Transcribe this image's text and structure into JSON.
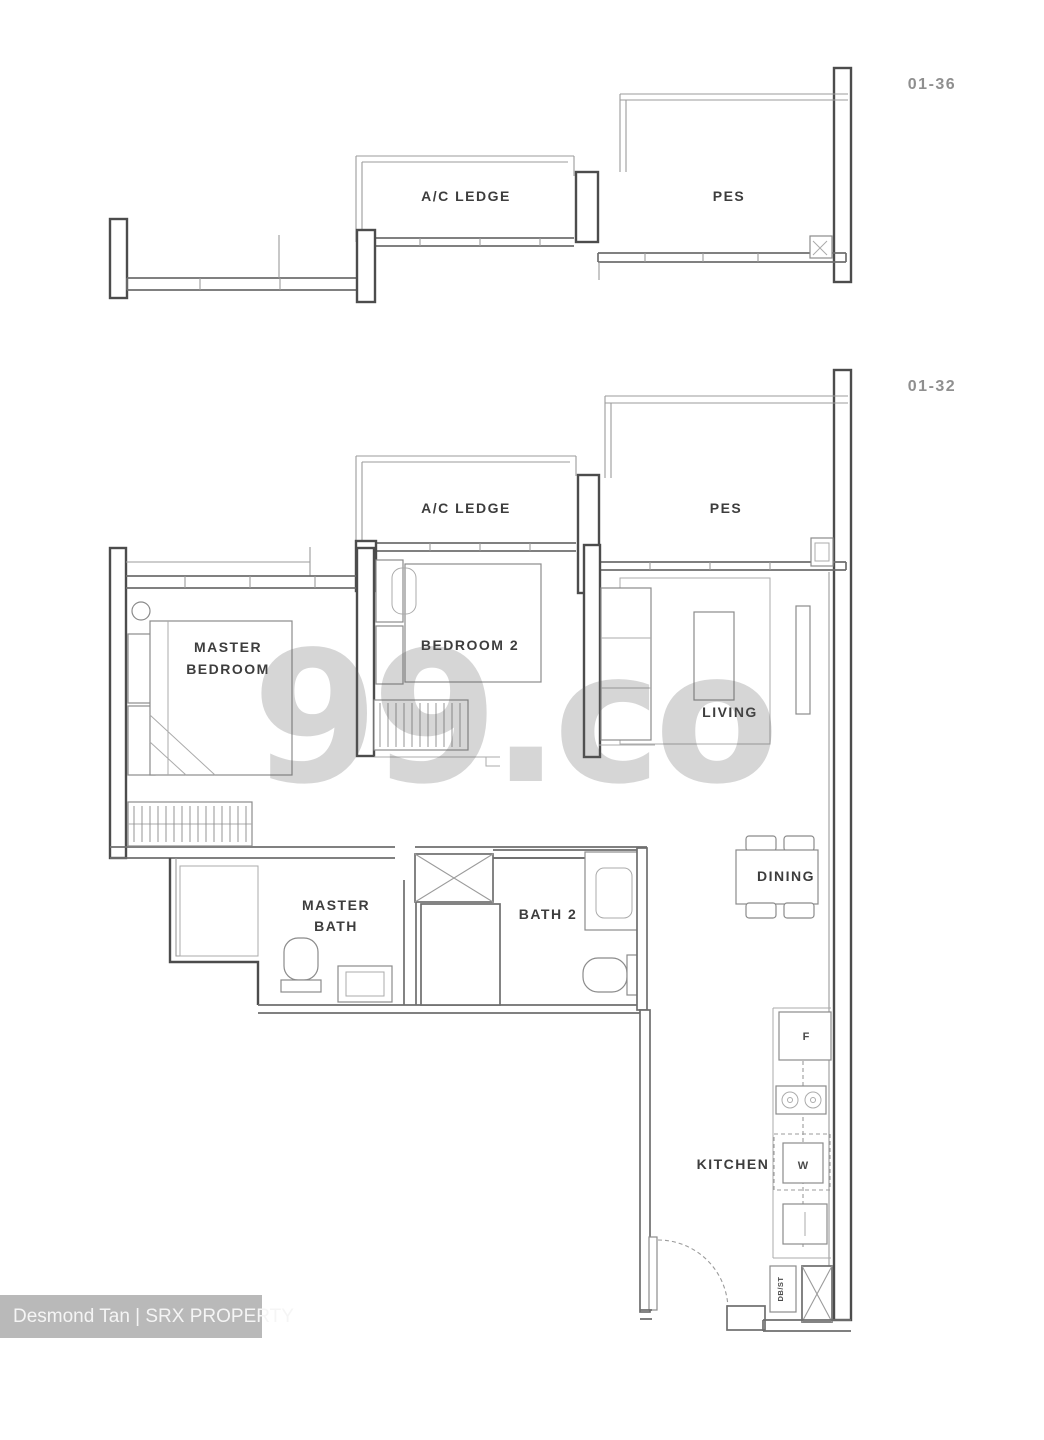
{
  "page": {
    "background": "#ffffff"
  },
  "watermark": {
    "text": "99.co",
    "color_hint": "#d2d2d2"
  },
  "credit_bar": {
    "text": "Desmond Tan | SRX PROPERTY",
    "background": "#b9b9b9",
    "text_color": "#f5f5f5"
  },
  "colors": {
    "wall_dark": "#4c4c4c",
    "wall_mid": "#6e6e6e",
    "line_light": "#9b9b9b",
    "room_label": "#3d3d3d",
    "unit_label": "#8f8f8f"
  },
  "top_plan": {
    "unit_id": "01-36",
    "ac_ledge_label": "A/C LEDGE",
    "pes_label": "PES"
  },
  "main_plan": {
    "unit_id": "01-32",
    "ac_ledge_label": "A/C LEDGE",
    "pes_label": "PES",
    "master_bedroom_label_line1": "MASTER",
    "master_bedroom_label_line2": "BEDROOM",
    "bedroom2_label": "BEDROOM 2",
    "living_label": "LIVING",
    "dining_label": "DINING",
    "master_bath_label_line1": "MASTER",
    "master_bath_label_line2": "BATH",
    "bath2_label": "BATH 2",
    "kitchen_label": "KITCHEN",
    "dbst_label": "DB/ST",
    "fridge_label": "F",
    "washer_label": "W"
  }
}
